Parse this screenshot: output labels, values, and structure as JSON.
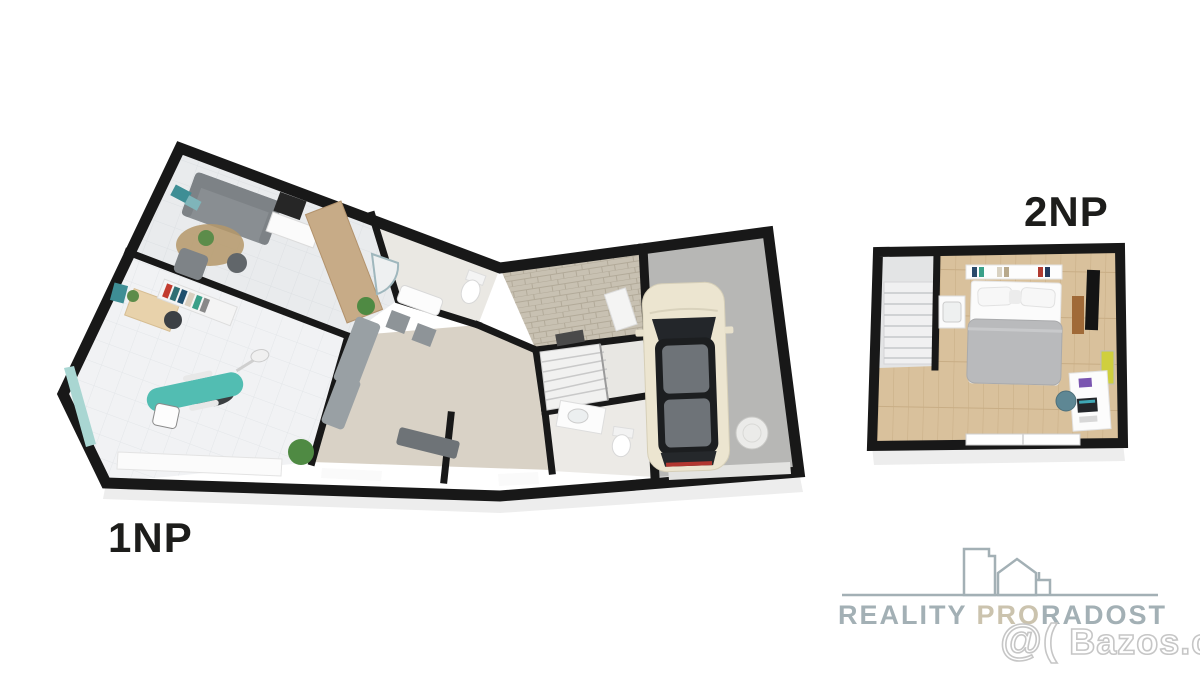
{
  "floor_labels": {
    "floor1": "1NP",
    "floor2": "2NP"
  },
  "branding": {
    "logo_word1": "REALITY",
    "logo_word2": "PRO",
    "logo_word3": "RADOST",
    "watermark_prefix": "@(",
    "watermark_site": "Bazos.cz"
  },
  "colors": {
    "background": "#ffffff",
    "wall": "#181818",
    "floor_label_text": "#1d1d1b",
    "logo_gray": "#a3b0b5",
    "logo_beige": "#cbc3ae",
    "watermark_outline": "#c6c6c6",
    "dental_chair": "#52bdb2",
    "car_body": "#ece5d0",
    "car_roof": "#1c1e20",
    "bed_duvet": "#b9babc",
    "wood_furniture": "#c7ab87",
    "bedroom_floor_wood": "#d9c19c",
    "corridor_carpet": "#d9d2c6",
    "entry_stone": "#c8c1b2",
    "garage_floor": "#b7b7b5",
    "sofa_gray": "#898e92",
    "plant_green": "#4f8a43",
    "glass_teal": "#a9d6d2"
  }
}
